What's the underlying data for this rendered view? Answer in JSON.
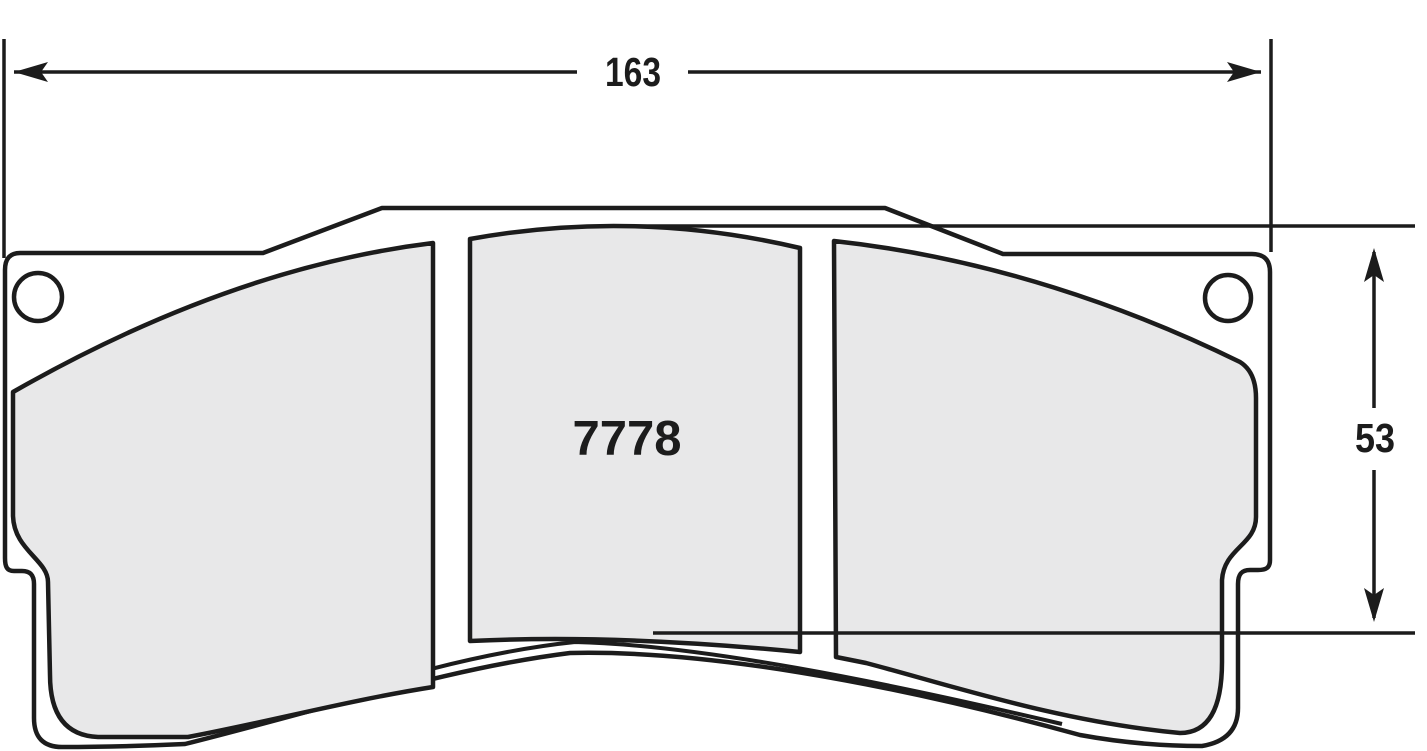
{
  "drawing": {
    "part_number": "7778",
    "dimensions": {
      "width": "163",
      "height": "53"
    },
    "colors": {
      "background": "#ffffff",
      "line": "#1c1c1c",
      "pad_fill": "#e8e8e9",
      "plate_fill": "#ffffff"
    }
  }
}
